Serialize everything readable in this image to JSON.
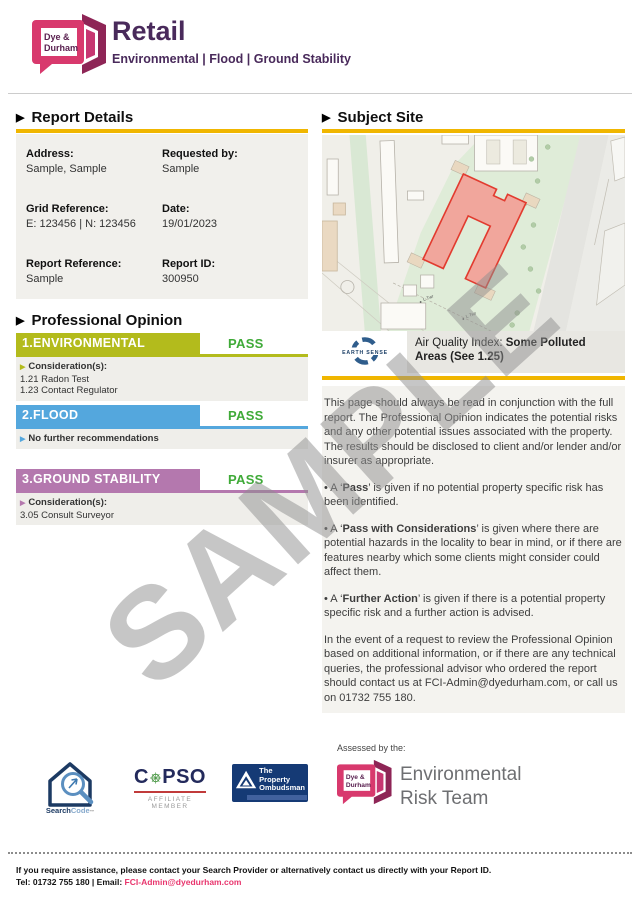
{
  "page": {
    "watermark": "SAMPLE"
  },
  "colors": {
    "accent_yellow": "#f0b600",
    "status_pass_green": "#3faa38",
    "environmental_bar": "#b3bb1c",
    "flood_bar": "#54a7dd",
    "ground_stability_bar": "#b478ae",
    "brand_pink": "#d8396d",
    "brand_maroon": "#8e2556",
    "heading_purple": "#492a5b",
    "site_outline_red": "#e23b2f",
    "site_fill_red": "#f59a92",
    "link_pink": "#e8356d"
  },
  "header": {
    "logo_line1": "Dye &",
    "logo_line2": "Durham",
    "title": "Retail",
    "subtitle": "Environmental | Flood | Ground Stability"
  },
  "report_details": {
    "heading": "Report Details",
    "fields": [
      {
        "label": "Address:",
        "value": "Sample, Sample"
      },
      {
        "label": "Requested by:",
        "value": "Sample"
      },
      {
        "label": "Grid Reference:",
        "value": "E: 123456 | N: 123456"
      },
      {
        "label": "Date:",
        "value": "19/01/2023"
      },
      {
        "label": "Report Reference:",
        "value": "Sample"
      },
      {
        "label": "Report ID:",
        "value": "300950"
      }
    ]
  },
  "professional_opinion": {
    "heading": "Professional Opinion",
    "sections": [
      {
        "title": "1.ENVIRONMENTAL",
        "status": "PASS",
        "lead": "Consideration(s):",
        "items": [
          "1.21 Radon Test",
          "1.23 Contact Regulator"
        ]
      },
      {
        "title": "2.FLOOD",
        "status": "PASS",
        "lead": "No further recommendations",
        "items": []
      },
      {
        "title": "3.GROUND STABILITY",
        "status": "PASS",
        "lead": "Consideration(s):",
        "items": [
          "3.05 Consult Surveyor"
        ]
      }
    ]
  },
  "subject_site": {
    "heading": "Subject Site",
    "map_labels": [
      "L Twr",
      "L Twr"
    ],
    "air_quality": {
      "provider": "EARTH SENSE",
      "label": "Air Quality Index: ",
      "value": "Some Polluted Areas (See 1.25)"
    }
  },
  "guidance": {
    "intro": "This page should always be read in conjunction with the full report.  The Professional Opinion indicates the potential risks and any other potential issues associated with the property. The results should be disclosed to client and/or lender and/or insurer as appropriate.",
    "bullets": [
      {
        "pre": "• A ‘",
        "term": "Pass",
        "post": "’ is given if no potential property specific risk has been identified."
      },
      {
        "pre": "• A ‘",
        "term": "Pass with Considerations",
        "post": "’ is given where there are potential hazards in the locality to bear in mind, or if there are features nearby which some clients might consider could affect them."
      },
      {
        "pre": "• A ‘",
        "term": "Further Action",
        "post": "’ is given if there is a potential property specific risk and a further action is advised."
      }
    ],
    "outro": "In the event of a request to review the Professional Opinion based on additional information, or if there are any technical queries, the professional advisor who ordered the report should contact us at FCI-Admin@dyedurham.com, or call us on 01732 755 180."
  },
  "footer": {
    "assessed_by": "Assessed by the:",
    "searchcode": {
      "part1": "Search",
      "part2": "Code",
      "tm": "™"
    },
    "copso": {
      "c": "C",
      "rest": "PSO",
      "subtitle": "AFFILIATE MEMBER"
    },
    "tpo": {
      "line1": "The Property",
      "line2": "Ombudsman"
    },
    "dd": {
      "logo_line1": "Dye &",
      "logo_line2": "Durham",
      "team_line1": "Environmental",
      "team_line2": "Risk Team"
    },
    "fine_print_line1": "If you require assistance, please contact your Search Provider or alternatively contact us directly with your Report ID.",
    "fine_print_tel": "Tel: 01732 755 180 | Email: ",
    "fine_print_email": "FCI-Admin@dyedurham.com"
  }
}
